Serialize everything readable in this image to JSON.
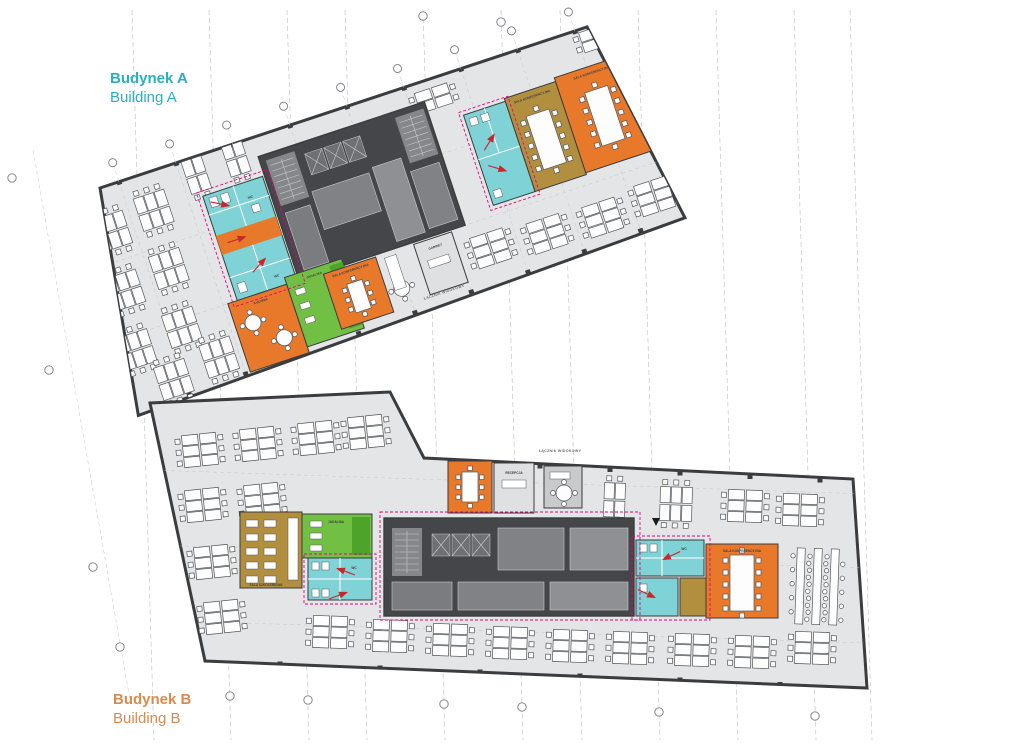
{
  "buildings": {
    "a": {
      "name_pl": "Budynek A",
      "name_en": "Building A",
      "accent": "#2BAEC4"
    },
    "b": {
      "name_pl": "Budynek B",
      "name_en": "Building B",
      "accent": "#DC8A4C"
    }
  },
  "room_labels": {
    "conference": "SALA KONFERENCYJNA",
    "wc": "WC",
    "kitchen": "KUCHNIA",
    "dining": "JADALNIA",
    "training": "SALA SZKOLENIOWA",
    "reception": "RECEPCJA",
    "office": "GABINET"
  },
  "site_labels": {
    "connector": "ŁĄCZNIK WIDOKOWY"
  },
  "palette": {
    "open_space": "#E4E5E7",
    "walls": "#3B3C3E",
    "core": "#45464A",
    "meeting_orange": "#E8792B",
    "sanitary_cyan": "#7FD3D6",
    "social_green": "#72C043",
    "social_green_dark": "#4EA32A",
    "training_olive": "#B18F3E",
    "escape_route_pink": "#E6007E",
    "escape_arrow_red": "#C9252C",
    "building_a_accent": "#2BAEC4",
    "building_b_accent": "#DC8A4C"
  }
}
